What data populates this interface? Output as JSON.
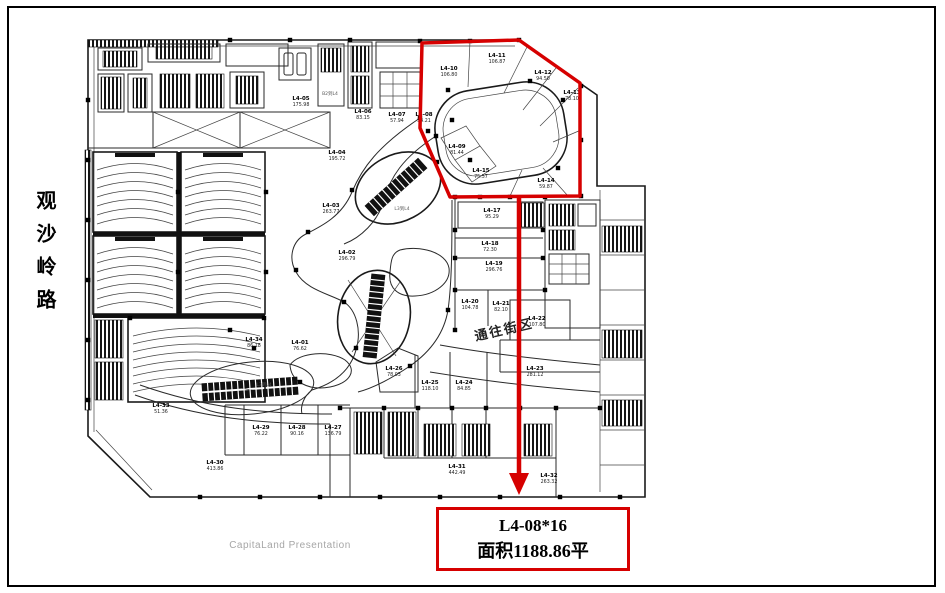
{
  "slide": {
    "background": "#ffffff",
    "frame_color": "#000000",
    "accent_color": "#d60000"
  },
  "road_label": {
    "text": "观沙岭路"
  },
  "corridor_label": {
    "text": "通往街区"
  },
  "watermark": {
    "text": "CapitaLand Presentation"
  },
  "callout": {
    "line1": "L4-08*16",
    "line2": "面积1188.86平"
  },
  "floor_plan": {
    "floor": "L4",
    "units": [
      {
        "label": "L4-01",
        "area": "76.62",
        "x": 300,
        "y": 344
      },
      {
        "label": "L4-02",
        "area": "296.79",
        "x": 347,
        "y": 254
      },
      {
        "label": "L4-03",
        "area": "263.77",
        "x": 331,
        "y": 207
      },
      {
        "label": "L4-04",
        "area": "195.72",
        "x": 337,
        "y": 154
      },
      {
        "label": "L4-05",
        "area": "175.98",
        "x": 301,
        "y": 100
      },
      {
        "label": "L4-06",
        "area": "83.15",
        "x": 363,
        "y": 113
      },
      {
        "label": "L4-07",
        "area": "57.94",
        "x": 397,
        "y": 116
      },
      {
        "label": "L4-08",
        "area": "34.21",
        "x": 424,
        "y": 116
      },
      {
        "label": "L4-09",
        "area": "81.44",
        "x": 457,
        "y": 148
      },
      {
        "label": "L4-10",
        "area": "106.80",
        "x": 449,
        "y": 70
      },
      {
        "label": "L4-11",
        "area": "106.87",
        "x": 497,
        "y": 57
      },
      {
        "label": "L4-12",
        "area": "94.50",
        "x": 543,
        "y": 74
      },
      {
        "label": "L4-13",
        "area": "78.10",
        "x": 572,
        "y": 94
      },
      {
        "label": "L4-14",
        "area": "59.87",
        "x": 546,
        "y": 182
      },
      {
        "label": "L4-15",
        "area": "75.57",
        "x": 481,
        "y": 172
      },
      {
        "label": "L4-17",
        "area": "95.29",
        "x": 492,
        "y": 212
      },
      {
        "label": "L4-18",
        "area": "72.30",
        "x": 490,
        "y": 245
      },
      {
        "label": "L4-19",
        "area": "296.76",
        "x": 494,
        "y": 265
      },
      {
        "label": "L4-20",
        "area": "104.78",
        "x": 470,
        "y": 303
      },
      {
        "label": "L4-21",
        "area": "82.10",
        "x": 501,
        "y": 305
      },
      {
        "label": "L4-22",
        "area": "107.80",
        "x": 537,
        "y": 320
      },
      {
        "label": "L4-23",
        "area": "281.12",
        "x": 535,
        "y": 370
      },
      {
        "label": "L4-24",
        "area": "84.85",
        "x": 464,
        "y": 384
      },
      {
        "label": "L4-25",
        "area": "118.10",
        "x": 430,
        "y": 384
      },
      {
        "label": "L4-26",
        "area": "78.03",
        "x": 394,
        "y": 370
      },
      {
        "label": "L4-27",
        "area": "136.79",
        "x": 333,
        "y": 429
      },
      {
        "label": "L4-28",
        "area": "90.16",
        "x": 297,
        "y": 429
      },
      {
        "label": "L4-29",
        "area": "76.22",
        "x": 261,
        "y": 429
      },
      {
        "label": "L4-30",
        "area": "413.86",
        "x": 215,
        "y": 464
      },
      {
        "label": "L4-31",
        "area": "442.49",
        "x": 457,
        "y": 468
      },
      {
        "label": "L4-32",
        "area": "263.32",
        "x": 549,
        "y": 477
      },
      {
        "label": "L4-33",
        "area": "51.36",
        "x": 161,
        "y": 407
      },
      {
        "label": "L4-34",
        "area": "86.18",
        "x": 254,
        "y": 341
      }
    ],
    "small_labels": [
      {
        "text": "B2到L4",
        "x": 330,
        "y": 95
      },
      {
        "text": "L3到L4",
        "x": 402,
        "y": 210
      },
      {
        "text": "L3到L4",
        "x": 264,
        "y": 386
      }
    ]
  }
}
